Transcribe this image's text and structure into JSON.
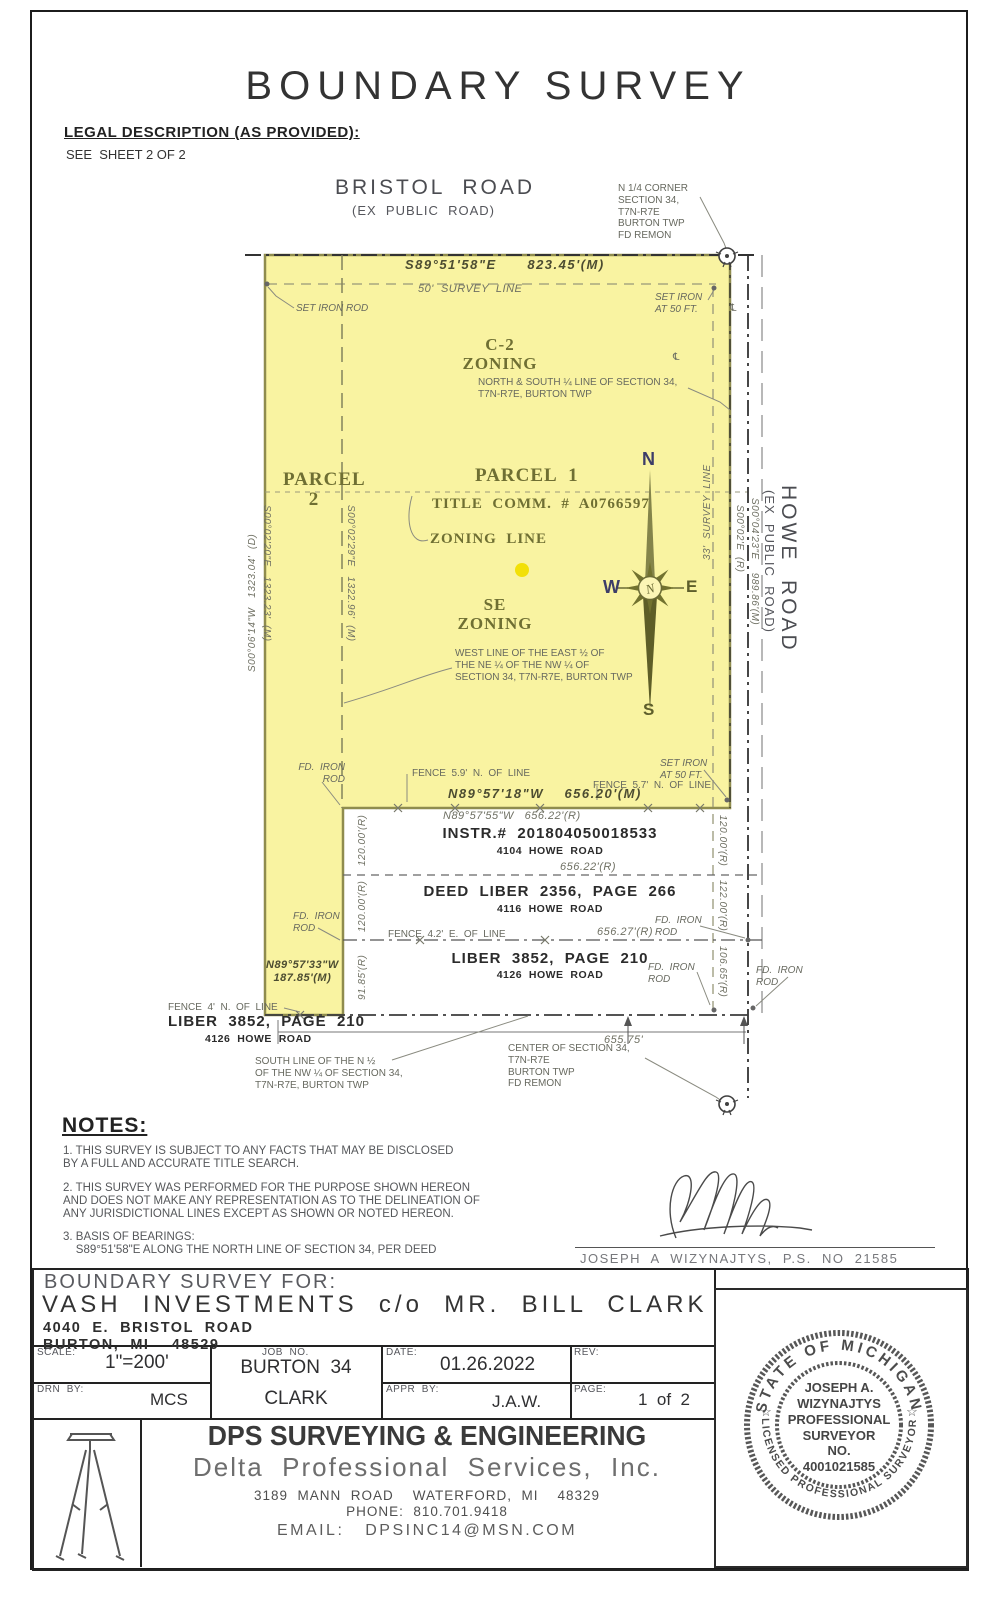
{
  "page": {
    "title": "BOUNDARY SURVEY"
  },
  "legal": {
    "heading": "LEGAL DESCRIPTION (AS PROVIDED):",
    "body": "SEE  SHEET 2 OF 2"
  },
  "drawing": {
    "highlight_color": "#f9f3a1",
    "annotations": [
      {
        "name": "road-label-bristol",
        "text": "BRISTOL  ROAD",
        "x": 335,
        "y": 176,
        "cls": "road-big"
      },
      {
        "name": "road-label-bristol-sub",
        "text": "(EX  PUBLIC  ROAD)",
        "x": 352,
        "y": 203,
        "cls": "road-sub"
      },
      {
        "name": "corner-note-n-quarter",
        "text": "N 1/4 CORNER\nSECTION 34,\nT7N-R7E\nBURTON TWP\nFD REMON",
        "x": 618,
        "y": 183,
        "cls": "gray10"
      },
      {
        "name": "bearing-north",
        "text": "S89°51'58\"E      823.45'(M)",
        "x": 405,
        "y": 257,
        "cls": "dimdark"
      },
      {
        "name": "survey-line-50-label",
        "text": "50'  SURVEY  LINE",
        "x": 418,
        "y": 283,
        "cls": "dimgray"
      },
      {
        "name": "set-iron-rod-nw-label",
        "text": "SET IRON ROD",
        "x": 296,
        "y": 303,
        "cls": "gray10 i"
      },
      {
        "name": "set-iron-ne-label",
        "text": "SET IRON\nAT 50 FT.",
        "x": 655,
        "y": 292,
        "cls": "gray10 i"
      },
      {
        "name": "zoning-c2-label",
        "text": "C-2\nZONING",
        "x": 455,
        "y": 336,
        "cls": "serifolive c17",
        "w": 90,
        "align": "center"
      },
      {
        "name": "quarter-line-note",
        "text": "NORTH & SOUTH ¼ LINE OF SECTION 34,\nT7N-R7E, BURTON TWP",
        "x": 478,
        "y": 377,
        "cls": "gray10"
      },
      {
        "name": "parcel-2-label",
        "text": "PARCEL\n2",
        "x": 283,
        "y": 470,
        "cls": "serifolive c19",
        "w": 62,
        "align": "center"
      },
      {
        "name": "parcel-1-label",
        "text": "PARCEL  1",
        "x": 475,
        "y": 466,
        "cls": "serifolive c19"
      },
      {
        "name": "title-comm-label",
        "text": "TITLE  COMM.  #  A0766597",
        "x": 432,
        "y": 496,
        "cls": "serifolive c15"
      },
      {
        "name": "zoning-line-label",
        "text": "ZONING  LINE",
        "x": 430,
        "y": 531,
        "cls": "serifolive c15"
      },
      {
        "name": "se-zoning-label",
        "text": "SE\nZONING",
        "x": 450,
        "y": 596,
        "cls": "serifolive c17",
        "w": 90,
        "align": "center"
      },
      {
        "name": "west-line-note",
        "text": "WEST LINE OF THE EAST ½ OF\nTHE NE ¼ OF THE NW ¼ OF\nSECTION 34, T7N-R7E, BURTON TWP",
        "x": 455,
        "y": 648,
        "cls": "gray10"
      },
      {
        "name": "dim-west-deed",
        "text": "S00°06'14\"W   1323.04'  (D)",
        "x": 247,
        "y": 672,
        "cls": "dimgray s10",
        "rot": -90
      },
      {
        "name": "dim-west-measured",
        "text": "S00°02'20\"E   1323.23'  (M)",
        "x": 272,
        "y": 505,
        "cls": "dimgray s10",
        "rot": 90
      },
      {
        "name": "dim-zoning-line",
        "text": "S00°02'29\"E   1322.96'  (M)",
        "x": 356,
        "y": 505,
        "cls": "dimgray s10",
        "rot": 90
      },
      {
        "name": "survey-line-33-label",
        "text": "33'  SURVEY  LINE",
        "x": 702,
        "y": 560,
        "cls": "dimgray s10",
        "rot": -90
      },
      {
        "name": "dim-howe-r",
        "text": "S00°02'E  (R)",
        "x": 745,
        "y": 505,
        "cls": "dimgray s10",
        "rot": 90
      },
      {
        "name": "dim-howe-m",
        "text": "S00°04'23\"E    989.86'(M)",
        "x": 760,
        "y": 498,
        "cls": "dimgray s10",
        "rot": 90
      },
      {
        "name": "road-label-howe",
        "text": "HOWE  ROAD",
        "x": 800,
        "y": 485,
        "cls": "road-big",
        "rot": 90
      },
      {
        "name": "road-label-howe-sub",
        "text": "(EX  PUBLIC  ROAD)",
        "x": 777,
        "y": 490,
        "cls": "road-sub",
        "rot": 90
      },
      {
        "name": "compass-letter-n",
        "text": "N",
        "x": 642,
        "y": 449,
        "cls": "compass-navy"
      },
      {
        "name": "compass-letter-w",
        "text": "W",
        "x": 603,
        "y": 577,
        "cls": "compass-navy"
      },
      {
        "name": "compass-letter-e",
        "text": "E",
        "x": 686,
        "y": 577,
        "cls": "compass-olive"
      },
      {
        "name": "compass-letter-s",
        "text": "S",
        "x": 643,
        "y": 700,
        "cls": "compass-olive"
      },
      {
        "name": "fd-iron-rod-sw-label",
        "text": "FD.  IRON\nROD",
        "x": 293,
        "y": 762,
        "cls": "gray10 i",
        "w": 52,
        "align": "right"
      },
      {
        "name": "fence-59-label",
        "text": "FENCE  5.9'  N.  OF  LINE",
        "x": 412,
        "y": 768,
        "cls": "gray10"
      },
      {
        "name": "bearing-south-m",
        "text": "N89°57'18\"W    656.20'(M)",
        "x": 448,
        "y": 786,
        "cls": "dimdark"
      },
      {
        "name": "bearing-south-r",
        "text": "N89°57'55\"W   656.22'(R)",
        "x": 443,
        "y": 810,
        "cls": "dimgray"
      },
      {
        "name": "set-iron-se-label",
        "text": "SET IRON\nAT 50 FT.",
        "x": 660,
        "y": 758,
        "cls": "gray10 i"
      },
      {
        "name": "fence-57-label",
        "text": "FENCE  5.7'  N.  OF  LINE",
        "x": 593,
        "y": 780,
        "cls": "gray10"
      },
      {
        "name": "lot1-instr",
        "text": "INSTR.#  201804050018533",
        "x": 390,
        "y": 825,
        "cls": "lothead",
        "w": 320,
        "align": "center"
      },
      {
        "name": "lot1-addr",
        "text": "4104  HOWE  ROAD",
        "x": 390,
        "y": 845,
        "cls": "lotaddr",
        "w": 320,
        "align": "center"
      },
      {
        "name": "dim-lot1",
        "text": "656.22'(R)",
        "x": 560,
        "y": 861,
        "cls": "dimgray"
      },
      {
        "name": "lot2-deed",
        "text": "DEED  LIBER  2356,  PAGE  266",
        "x": 390,
        "y": 883,
        "cls": "lothead",
        "w": 320,
        "align": "center"
      },
      {
        "name": "lot2-addr",
        "text": "4116  HOWE  ROAD",
        "x": 390,
        "y": 903,
        "cls": "lotaddr",
        "w": 320,
        "align": "center"
      },
      {
        "name": "fence-42-label",
        "text": "FENCE  4.2'  E.  OF  LINE",
        "x": 388,
        "y": 929,
        "cls": "gray10"
      },
      {
        "name": "dim-lot2",
        "text": "656.27'(R)",
        "x": 597,
        "y": 926,
        "cls": "dimgray"
      },
      {
        "name": "fd-iron-rod-e1-label",
        "text": "FD.  IRON\nROD",
        "x": 655,
        "y": 915,
        "cls": "gray10 i"
      },
      {
        "name": "lot3-liber",
        "text": "LIBER  3852,  PAGE  210",
        "x": 390,
        "y": 950,
        "cls": "lothead",
        "w": 320,
        "align": "center"
      },
      {
        "name": "lot3-addr",
        "text": "4126  HOWE  ROAD",
        "x": 390,
        "y": 969,
        "cls": "lotaddr",
        "w": 320,
        "align": "center"
      },
      {
        "name": "fd-iron-rod-e2-label",
        "text": "FD.  IRON\nROD",
        "x": 648,
        "y": 962,
        "cls": "gray10 i"
      },
      {
        "name": "fd-iron-rod-e3-label",
        "text": "FD.  IRON\nROD",
        "x": 756,
        "y": 965,
        "cls": "gray10 i"
      },
      {
        "name": "fd-iron-rod-strip-label",
        "text": "FD.  IRON\nROD",
        "x": 293,
        "y": 911,
        "cls": "gray10 i"
      },
      {
        "name": "bearing-strip",
        "text": "N89°57'33\"W\n187.85'(M)",
        "x": 266,
        "y": 959,
        "cls": "dim11"
      },
      {
        "name": "dim-left-120a",
        "text": "120.00'(R)",
        "x": 357,
        "y": 866,
        "cls": "dimgray s10",
        "rot": -90
      },
      {
        "name": "dim-left-120b",
        "text": "120.00'(R)",
        "x": 357,
        "y": 932,
        "cls": "dimgray s10",
        "rot": -90
      },
      {
        "name": "dim-left-9185",
        "text": "91.85'(R)",
        "x": 357,
        "y": 1000,
        "cls": "dimgray s10",
        "rot": -90
      },
      {
        "name": "dim-right-120",
        "text": "120.00'(R)",
        "x": 728,
        "y": 815,
        "cls": "dimgray s10",
        "rot": 90
      },
      {
        "name": "dim-right-122",
        "text": "122.00'(R)",
        "x": 728,
        "y": 880,
        "cls": "dimgray s10",
        "rot": 90
      },
      {
        "name": "dim-right-10665",
        "text": "106.65'(R)",
        "x": 728,
        "y": 946,
        "cls": "dimgray s10",
        "rot": 90
      },
      {
        "name": "fence-4n-label",
        "text": "FENCE  4'  N.  OF  LINE",
        "x": 168,
        "y": 1002,
        "cls": "gray10"
      },
      {
        "name": "liber-3852-sw",
        "text": "LIBER  3852,  PAGE  210",
        "x": 168,
        "y": 1013,
        "cls": "lothead"
      },
      {
        "name": "addr-4126-sw",
        "text": "4126  HOWE  ROAD",
        "x": 205,
        "y": 1033,
        "cls": "lotaddr"
      },
      {
        "name": "dim-south",
        "text": "655.75'",
        "x": 604,
        "y": 1034,
        "cls": "dimgray"
      },
      {
        "name": "south-line-note",
        "text": "SOUTH LINE OF THE N ½\nOF THE NW ¼ OF SECTION 34,\nT7N-R7E, BURTON TWP",
        "x": 255,
        "y": 1056,
        "cls": "gray10"
      },
      {
        "name": "center-section-note",
        "text": "CENTER OF SECTION 34,\nT7N-R7E\nBURTON TWP\nFD REMON",
        "x": 508,
        "y": 1043,
        "cls": "gray10"
      },
      {
        "name": "centerline-mark-1",
        "text": "℄",
        "x": 730,
        "y": 303,
        "cls": "gray10"
      },
      {
        "name": "centerline-mark-2",
        "text": "℄",
        "x": 673,
        "y": 352,
        "cls": "gray10"
      }
    ]
  },
  "notes": {
    "heading": "NOTES:",
    "items": [
      "1. THIS SURVEY IS SUBJECT TO ANY FACTS THAT MAY BE DISCLOSED\nBY A FULL AND ACCURATE TITLE SEARCH.",
      "2. THIS SURVEY WAS PERFORMED FOR THE PURPOSE SHOWN HEREON\nAND DOES NOT MAKE ANY REPRESENTATION AS TO THE DELINEATION OF\nANY JURISDICTIONAL LINES EXCEPT AS SHOWN OR NOTED HEREON.",
      "3. BASIS OF BEARINGS:\n    S89°51'58\"E ALONG THE NORTH LINE OF SECTION 34, PER DEED"
    ]
  },
  "surveyor": {
    "signature_name": "JOSEPH  A  WIZYNAJTYS,  P.S.  NO  21585"
  },
  "titleblock": {
    "for_label": "BOUNDARY SURVEY FOR:",
    "client": "VASH  INVESTMENTS  c/o  MR.  BILL  CLARK",
    "address1": "4040  E.  BRISTOL  ROAD",
    "address2": "BURTON,  MI    48529",
    "scale_label": "SCALE:",
    "scale": "1\"=200'",
    "job_label": "JOB  NO.",
    "job": "BURTON  34",
    "job2": "CLARK",
    "date_label": "DATE:",
    "date": "01.26.2022",
    "rev_label": "REV:",
    "drn_label": "DRN  BY:",
    "drn": "MCS",
    "appr_label": "APPR  BY:",
    "appr": "J.A.W.",
    "page_label": "PAGE:",
    "page": "1  of  2",
    "company": {
      "name": "DPS SURVEYING & ENGINEERING",
      "subname": "Delta  Professional  Services,  Inc.",
      "address": "3189  MANN  ROAD    WATERFORD,  MI    48329",
      "phone": "PHONE:  810.701.9418",
      "email": "EMAIL:   DPSINC14@MSN.COM"
    }
  },
  "seal": {
    "arc_top": "STATE OF MICHIGAN",
    "arc_bottom": "LICENSED PROFESSIONAL SURVEYOR",
    "star": "☆",
    "lines": [
      "JOSEPH  A.",
      "WIZYNAJTYS",
      "PROFESSIONAL",
      "SURVEYOR",
      "NO.",
      "4001021585"
    ]
  }
}
